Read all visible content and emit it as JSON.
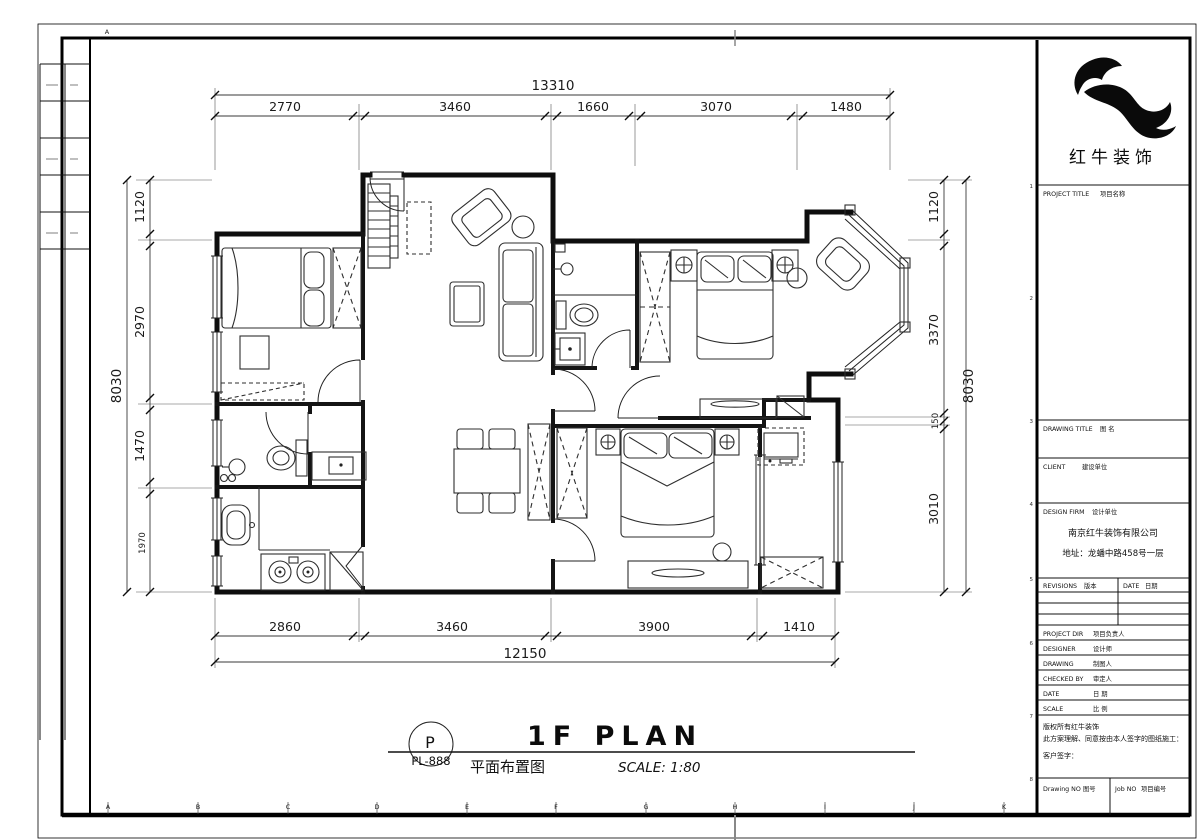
{
  "sheet": {
    "top_letter": "A",
    "bottom_letters": [
      "A",
      "B",
      "C",
      "D",
      "E",
      "F",
      "G",
      "H",
      "I",
      "J",
      "K"
    ],
    "side_numbers": [
      "1",
      "2",
      "3",
      "4",
      "5",
      "6",
      "7",
      "8"
    ]
  },
  "dims": {
    "top": {
      "total": "13310",
      "segments": [
        "2770",
        "3460",
        "1660",
        "3070",
        "1480"
      ]
    },
    "bottom": {
      "total": "12150",
      "segments": [
        "2860",
        "3460",
        "3900",
        "1410"
      ]
    },
    "left": {
      "total": "8030",
      "segments": [
        "1120",
        "2970",
        "1470",
        "1970"
      ]
    },
    "right": {
      "total": "8030",
      "segments": [
        "1120",
        "3370",
        "150",
        "3010"
      ]
    }
  },
  "plan_title": {
    "tag_letter": "P",
    "tag_code": "PL-888",
    "title": "1F PLAN",
    "subtitle": "平面布置图",
    "scale": "SCALE: 1:80"
  },
  "titleblock": {
    "brand": "红牛装饰",
    "project_title": "PROJECT TITLE",
    "project_title_cn": "项目名称",
    "drawing_title": "DRAWING TITLE",
    "drawing_title_cn": "图 名",
    "client": "CLIENT",
    "client_cn": "建设单位",
    "design_firm": "DESIGN FIRM",
    "design_firm_cn": "设计单位",
    "company": "南京红牛装饰有限公司",
    "address": "地址：龙蟠中路458号一层",
    "revisions": "REVISIONS",
    "revisions_cn": "版本",
    "date_col": "DATE",
    "date_col_cn": "日期",
    "rows": [
      {
        "en": "PROJECT DIR",
        "cn": "项目负责人"
      },
      {
        "en": "DESIGNER",
        "cn": "设计师"
      },
      {
        "en": "DRAWING",
        "cn": "制图人"
      },
      {
        "en": "CHECKED BY",
        "cn": "审定人"
      },
      {
        "en": "DATE",
        "cn": "日 期"
      },
      {
        "en": "SCALE",
        "cn": "比 例"
      }
    ],
    "note_line1": "版权所有红牛装饰",
    "note_line2": "此方案理解、同意按由本人签字的图纸施工：",
    "note_line3": "客户签字：",
    "drawing_no": "Drawing NO",
    "drawing_no_cn": "图号",
    "job_no": "Job NO",
    "job_no_cn": "项目编号"
  }
}
